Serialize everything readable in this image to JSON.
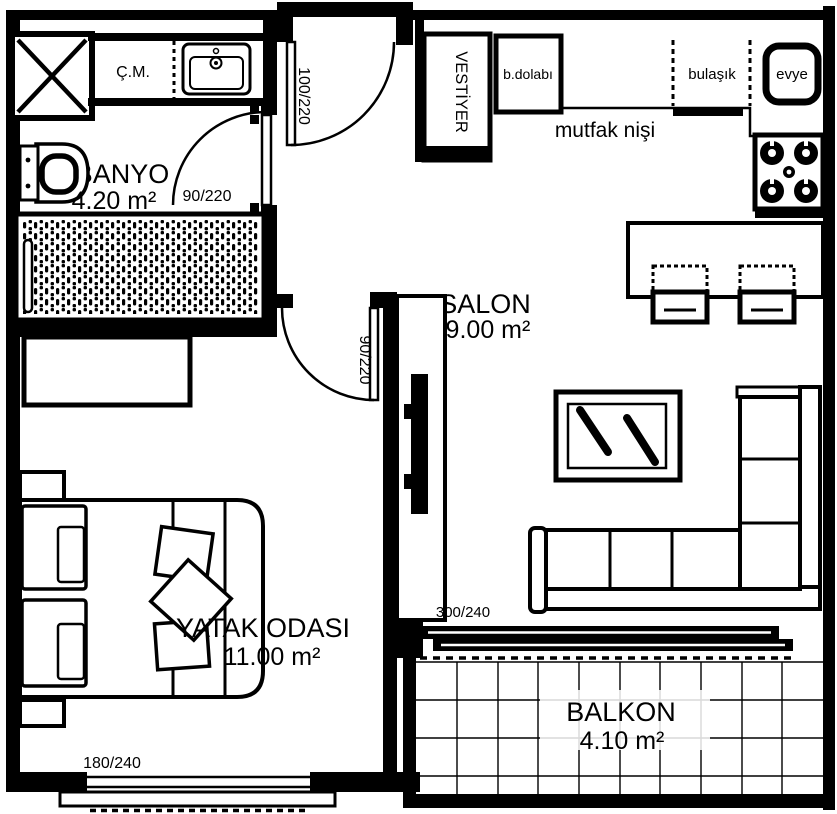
{
  "plan_title": "apartment-floor-plan",
  "colors": {
    "ink": "#000000",
    "paper": "#ffffff"
  },
  "rooms": {
    "banyo": {
      "name": "BANYO",
      "area": "4.20 m²"
    },
    "salon": {
      "name": "SALON",
      "area": "19.00 m²"
    },
    "yatak": {
      "name": "YATAK ODASI",
      "area": "11.00 m²"
    },
    "balkon": {
      "name": "BALKON",
      "area": "4.10 m²"
    }
  },
  "fixtures": {
    "washing_machine": "Ç.M.",
    "closet": "VESTİYER",
    "fridge": "b.dolabı",
    "dishwasher": "bulaşık",
    "sink": "evye",
    "kitchen_niche": "mutfak nişi"
  },
  "dims": {
    "entrance_door": "100/220",
    "bathroom_door": "90/220",
    "bedroom_door": "90/220",
    "balcony_door": "300/240",
    "bedroom_window": "180/240"
  }
}
